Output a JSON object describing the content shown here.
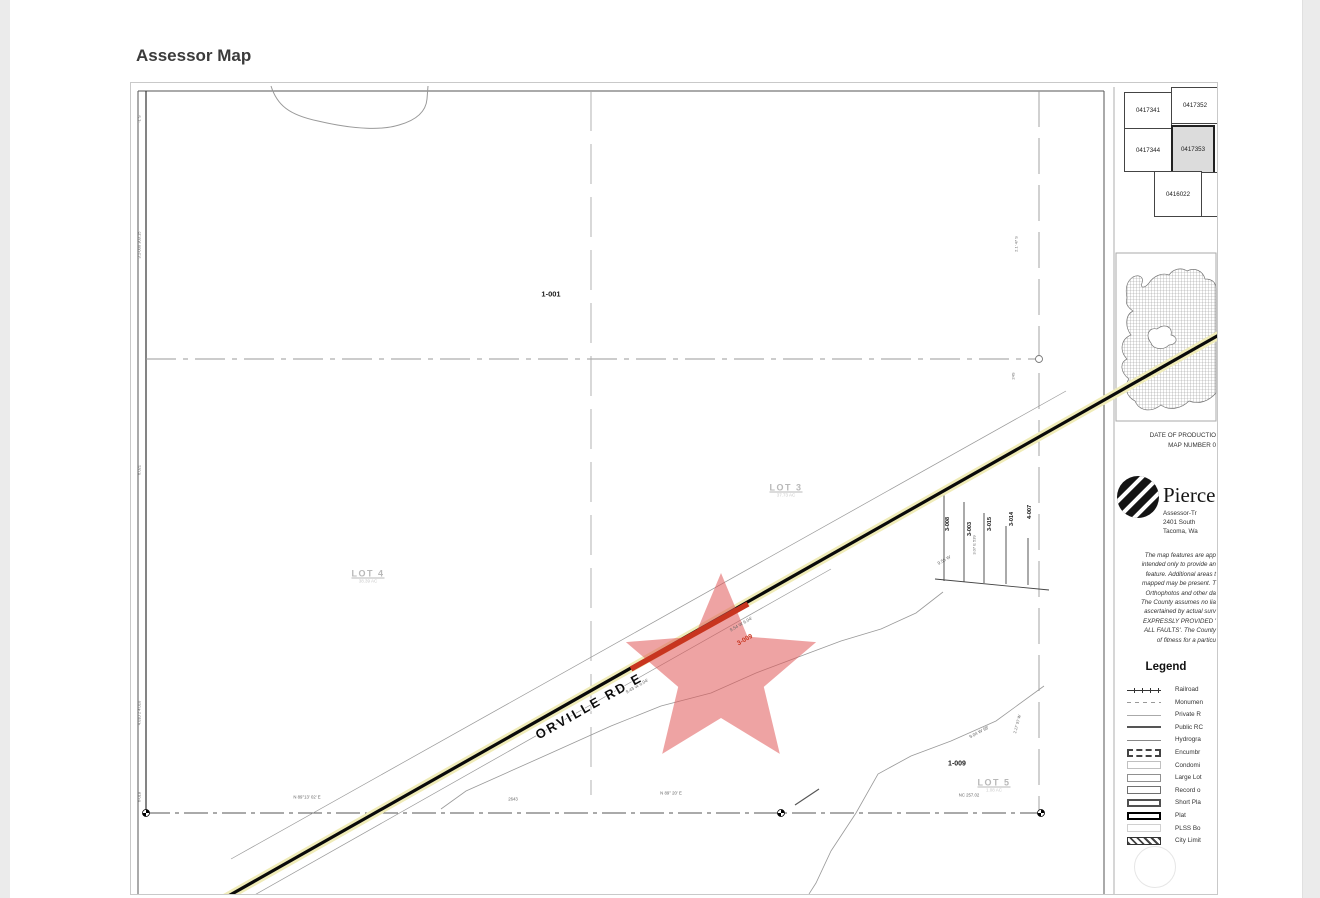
{
  "page": {
    "heading": "Assessor Map"
  },
  "map": {
    "road_label": "ORVILLE RD E",
    "colors": {
      "star": "#e05858",
      "road_highlight": "#c8351f",
      "road_casing": "#f0ecb8"
    },
    "marker": {
      "cx": 590,
      "cy": 590,
      "r": 100,
      "inner_ratio": 0.45,
      "color": "#e05858",
      "opacity": 0.55
    },
    "lots": [
      {
        "name": "LOT 3",
        "area": "37.73 AC",
        "x": 655,
        "y": 407
      },
      {
        "name": "LOT 4",
        "area": "38.39 AC",
        "x": 237,
        "y": 493
      },
      {
        "name": "LOT 5",
        "area": "1.08 AC",
        "x": 863,
        "y": 702
      }
    ],
    "labels": [
      {
        "text": "1-001",
        "x": 420,
        "y": 211,
        "size": 7.5,
        "color": "#1a1a1a",
        "bold": true
      },
      {
        "text": "1-009",
        "x": 826,
        "y": 681,
        "size": 7,
        "color": "#1a1a1a",
        "bold": true
      },
      {
        "text": "3-009",
        "x": 614,
        "y": 557,
        "size": 6.5,
        "color": "#c8351f",
        "bold": true,
        "rot": -30
      },
      {
        "text": "3-008",
        "x": 817,
        "y": 441,
        "size": 5.5,
        "color": "#111",
        "bold": true,
        "rot": -90
      },
      {
        "text": "3-003",
        "x": 839,
        "y": 446,
        "size": 5.5,
        "color": "#111",
        "bold": true,
        "rot": -90
      },
      {
        "text": "3-015",
        "x": 859,
        "y": 441,
        "size": 5.5,
        "color": "#111",
        "bold": true,
        "rot": -90
      },
      {
        "text": "3-014",
        "x": 881,
        "y": 436,
        "size": 5.5,
        "color": "#111",
        "bold": true,
        "rot": -90
      },
      {
        "text": "4-007",
        "x": 899,
        "y": 429,
        "size": 5.5,
        "color": "#111",
        "bold": true,
        "rot": -90
      },
      {
        "text": "9.43 W  6.04'",
        "x": 506,
        "y": 603,
        "rot": -30
      },
      {
        "text": "9.54 W  6.04'",
        "x": 610,
        "y": 541,
        "rot": -30
      },
      {
        "text": "9.56 W",
        "x": 813,
        "y": 477,
        "rot": -30
      },
      {
        "text": "3.07 E  539",
        "x": 843,
        "y": 462,
        "size": 4,
        "rot": -90
      },
      {
        "text": "9.04 W  98'",
        "x": 848,
        "y": 649,
        "rot": -28
      },
      {
        "text": "2.17'  97 W",
        "x": 886,
        "y": 641,
        "size": 4,
        "rot": -75
      },
      {
        "text": "2.1'  47 S",
        "x": 885,
        "y": 161,
        "size": 4,
        "rot": -90
      },
      {
        "text": "24S",
        "x": 882,
        "y": 293,
        "size": 4,
        "rot": -90
      },
      {
        "text": "N 89°13' 02' E",
        "x": 176,
        "y": 714,
        "size": 4.3
      },
      {
        "text": "2643",
        "x": 382,
        "y": 716,
        "size": 4.3
      },
      {
        "text": "N 89° 20' E",
        "x": 540,
        "y": 710,
        "size": 4.3
      },
      {
        "text": "NC  257.02",
        "x": 838,
        "y": 712,
        "size": 4.3
      },
      {
        "text": "-1 S",
        "x": 8,
        "y": 36,
        "size": 4,
        "rot": -90
      },
      {
        "text": "3.1-000  303.15",
        "x": 8,
        "y": 162,
        "size": 4,
        "rot": -90
      },
      {
        "text": "6.021",
        "x": 8,
        "y": 387,
        "size": 4,
        "rot": -90
      },
      {
        "text": "4.010 2 4.010",
        "x": 8,
        "y": 630,
        "size": 4,
        "rot": -90
      },
      {
        "text": "6-018",
        "x": 8,
        "y": 714,
        "size": 4,
        "rot": -90
      }
    ]
  },
  "sidebar": {
    "parcel_grid_cells": [
      {
        "id": "0417341",
        "x": 993,
        "y": 9,
        "w": 46,
        "h": 35
      },
      {
        "id": "0417352",
        "x": 1040,
        "y": 4,
        "w": 46,
        "h": 35
      },
      {
        "id": "0417344",
        "x": 993,
        "y": 45,
        "w": 46,
        "h": 42
      },
      {
        "id": "0417353",
        "x": 1040,
        "y": 42,
        "w": 40,
        "h": 45,
        "highlight": true
      },
      {
        "id": "0416022",
        "x": 1023,
        "y": 88,
        "w": 46,
        "h": 44
      },
      {
        "id": "",
        "x": 1070,
        "y": 89,
        "w": 16,
        "h": 43
      }
    ],
    "production_lines": [
      "DATE OF PRODUCTIO",
      "MAP NUMBER 0"
    ],
    "agency": {
      "name": "Pierce",
      "lines": [
        "Assessor-Tr",
        "2401 South",
        "Tacoma, Wa"
      ]
    },
    "disclaimer_lines": [
      "The map features are app",
      "intended only to provide an",
      "feature.  Additional areas t",
      "mapped may be present.  T",
      "Orthophotos and other da",
      "The County assumes no lia",
      "ascertained by actual surv",
      "EXPRESSLY PROVIDED '",
      "ALL FAULTS'.  The County",
      "of fitness for a particu"
    ],
    "legend": {
      "title": "Legend",
      "items": [
        {
          "symbol": "railroad",
          "label": "Railroad"
        },
        {
          "symbol": "monument",
          "label": "Monumen"
        },
        {
          "symbol": "private-road",
          "label": "Private R"
        },
        {
          "symbol": "public-road",
          "label": "Public RC"
        },
        {
          "symbol": "hydrography",
          "label": "Hydrogra"
        },
        {
          "symbol": "encumbrance",
          "label": "Encumbr"
        },
        {
          "symbol": "condominium",
          "label": "Condomi"
        },
        {
          "symbol": "large-lot",
          "label": "Large Lot"
        },
        {
          "symbol": "record-of-survey",
          "label": "Record o"
        },
        {
          "symbol": "short-plat",
          "label": "Short Pla"
        },
        {
          "symbol": "plat",
          "label": "Plat"
        },
        {
          "symbol": "plss-boundary",
          "label": "PLSS Bo"
        },
        {
          "symbol": "city-limit",
          "label": "City Limit"
        }
      ]
    }
  }
}
